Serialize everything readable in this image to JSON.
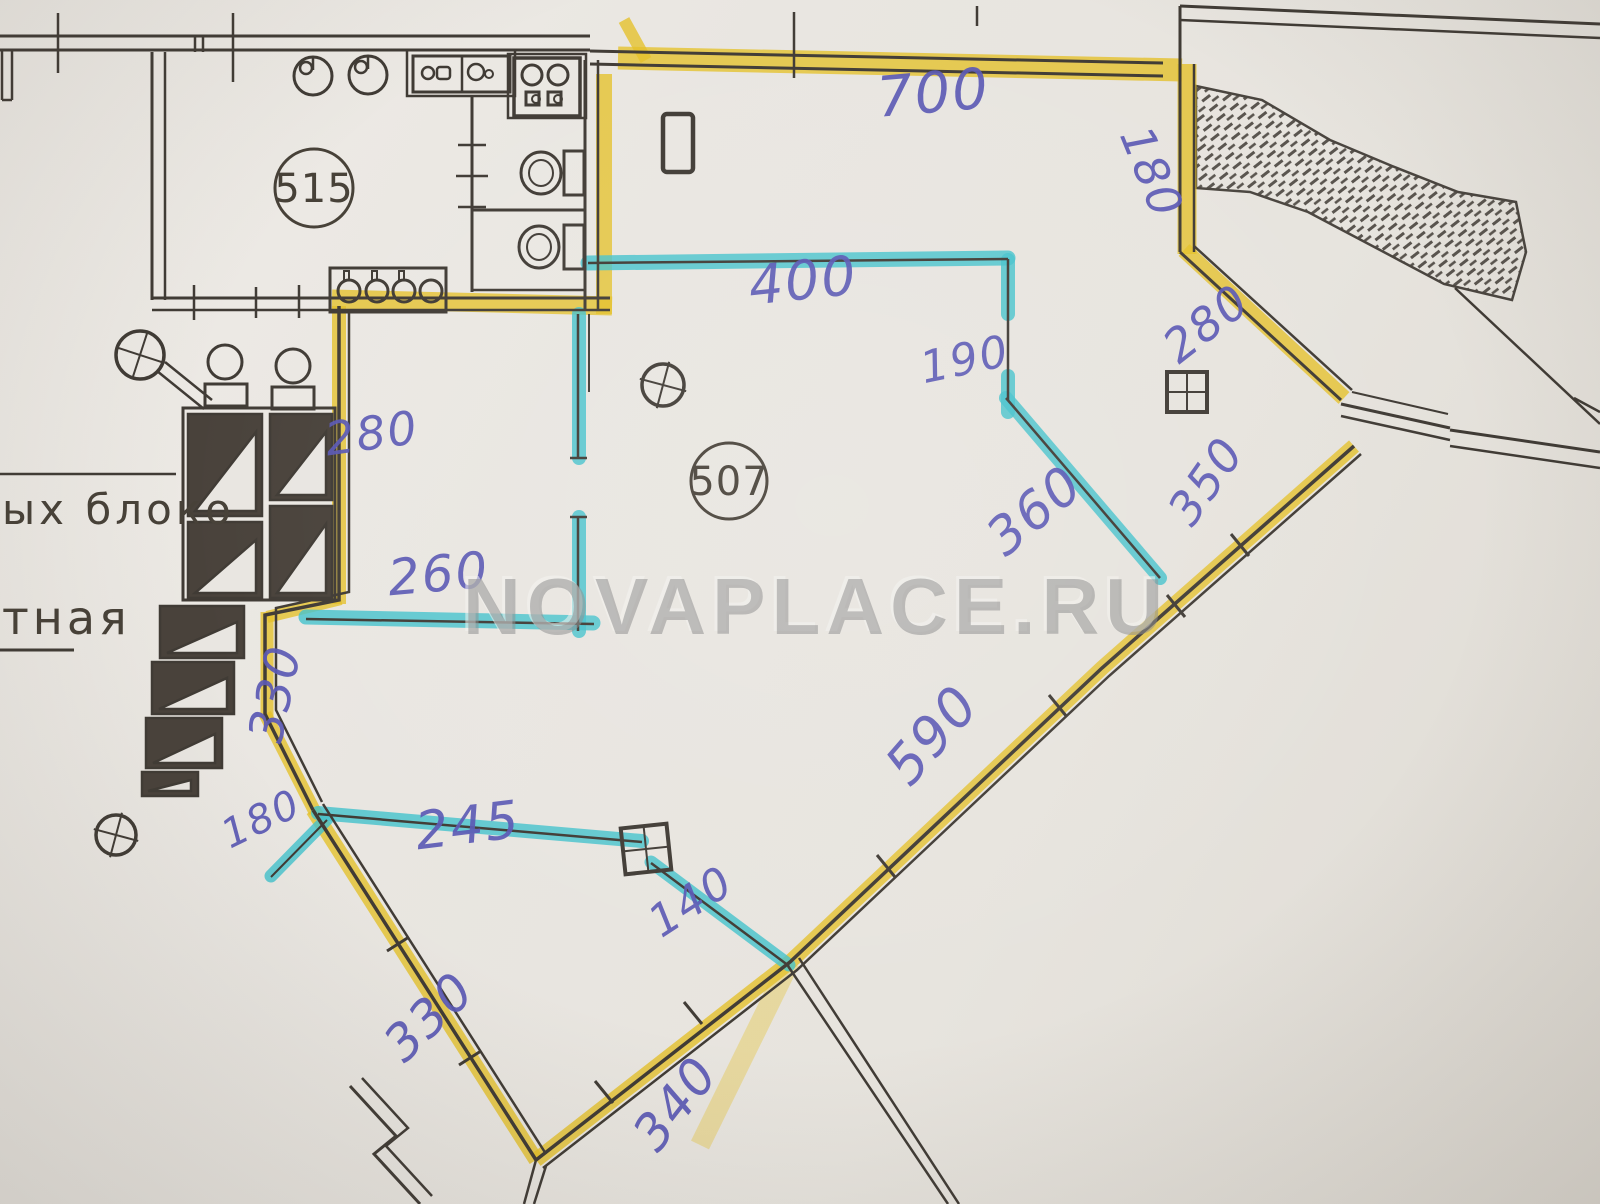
{
  "photo": {
    "description": "scanned floor plan with highlighter tracing",
    "watermark": "NOVAPLACE.RU",
    "rooms": [
      {
        "number": "515"
      },
      {
        "number": "507"
      }
    ],
    "margin_texts": [
      {
        "text": "ых блоко"
      },
      {
        "text": "тная"
      }
    ],
    "colors": {
      "paper": "#e8e5e0",
      "ink_lines": "#403b35",
      "highlight_yellow": "#e4c028",
      "highlight_cyan": "#45c2cc",
      "pen_blue": "#5a58b4",
      "watermark_gray": "#8c8c8c"
    },
    "dimensions": [
      {
        "value": "700",
        "x": 935,
        "y": 112,
        "rot": -5,
        "size": 56
      },
      {
        "value": "180",
        "x": 1137,
        "y": 178,
        "rot": 68,
        "size": 46
      },
      {
        "value": "400",
        "x": 805,
        "y": 299,
        "rot": -6,
        "size": 54
      },
      {
        "value": "190",
        "x": 968,
        "y": 374,
        "rot": -12,
        "size": 44
      },
      {
        "value": "360",
        "x": 1046,
        "y": 524,
        "rot": -40,
        "size": 52
      },
      {
        "value": "280",
        "x": 1216,
        "y": 336,
        "rot": -38,
        "size": 46
      },
      {
        "value": "350",
        "x": 1219,
        "y": 490,
        "rot": -55,
        "size": 46
      },
      {
        "value": "280",
        "x": 374,
        "y": 449,
        "rot": -8,
        "size": 46
      },
      {
        "value": "260",
        "x": 440,
        "y": 591,
        "rot": -5,
        "size": 50
      },
      {
        "value": "330",
        "x": 291,
        "y": 697,
        "rot": -78,
        "size": 48
      },
      {
        "value": "180",
        "x": 267,
        "y": 831,
        "rot": -26,
        "size": 40
      },
      {
        "value": "245",
        "x": 470,
        "y": 843,
        "rot": -7,
        "size": 52
      },
      {
        "value": "140",
        "x": 699,
        "y": 914,
        "rot": -33,
        "size": 44
      },
      {
        "value": "590",
        "x": 946,
        "y": 747,
        "rot": -49,
        "size": 54
      },
      {
        "value": "330",
        "x": 441,
        "y": 1029,
        "rot": -44,
        "size": 50
      },
      {
        "value": "340",
        "x": 689,
        "y": 1114,
        "rot": -52,
        "size": 50
      }
    ]
  }
}
